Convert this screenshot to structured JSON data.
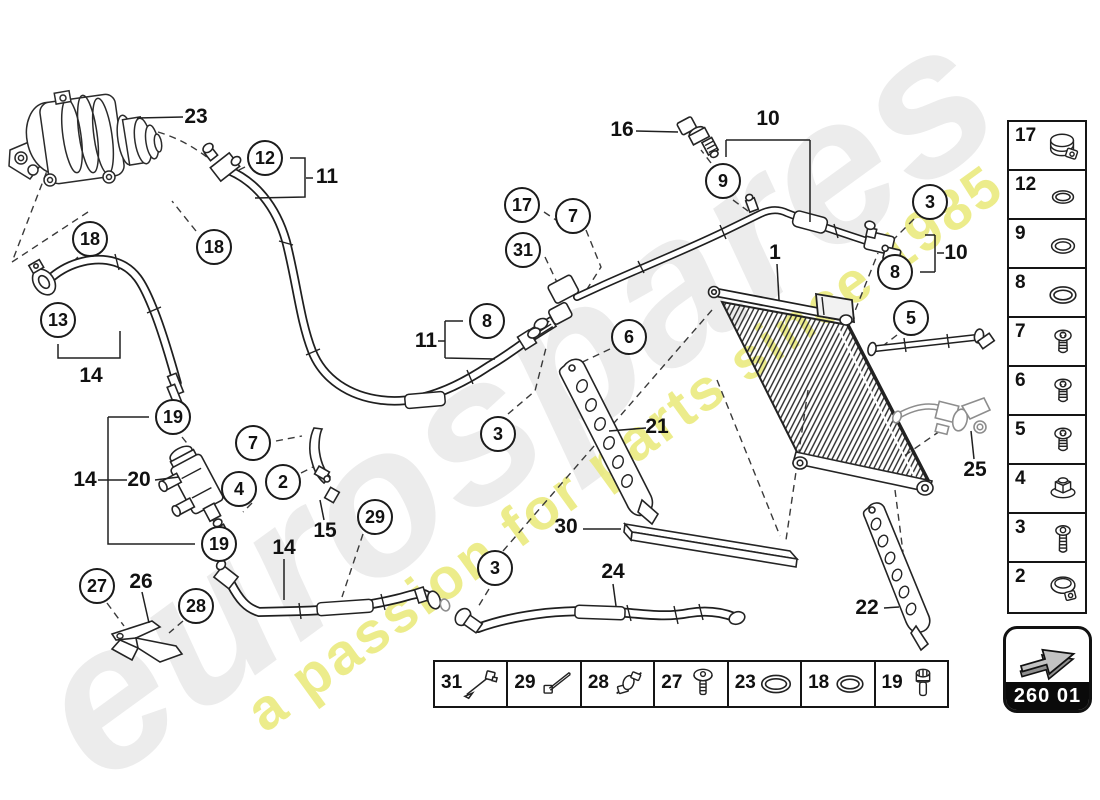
{
  "watermark": {
    "brand": "eurospares",
    "tagline": "a passion for parts since 1985"
  },
  "nav_box": {
    "code": "260 01"
  },
  "diagram": {
    "callouts": [
      {
        "n": "12",
        "x": 265,
        "y": 158
      },
      {
        "n": "18",
        "x": 90,
        "y": 239
      },
      {
        "n": "18",
        "x": 214,
        "y": 247
      },
      {
        "n": "13",
        "x": 58,
        "y": 320
      },
      {
        "n": "19",
        "x": 173,
        "y": 417
      },
      {
        "n": "7",
        "x": 253,
        "y": 443
      },
      {
        "n": "4",
        "x": 239,
        "y": 489
      },
      {
        "n": "2",
        "x": 283,
        "y": 482
      },
      {
        "n": "19",
        "x": 219,
        "y": 544
      },
      {
        "n": "27",
        "x": 97,
        "y": 586
      },
      {
        "n": "28",
        "x": 196,
        "y": 606
      },
      {
        "n": "29",
        "x": 375,
        "y": 517
      },
      {
        "n": "3",
        "x": 495,
        "y": 568
      },
      {
        "n": "3",
        "x": 498,
        "y": 434
      },
      {
        "n": "17",
        "x": 522,
        "y": 205
      },
      {
        "n": "7",
        "x": 573,
        "y": 216
      },
      {
        "n": "31",
        "x": 523,
        "y": 250
      },
      {
        "n": "8",
        "x": 487,
        "y": 321
      },
      {
        "n": "6",
        "x": 629,
        "y": 337
      },
      {
        "n": "9",
        "x": 723,
        "y": 181
      },
      {
        "n": "3",
        "x": 930,
        "y": 202
      },
      {
        "n": "8",
        "x": 895,
        "y": 272
      },
      {
        "n": "5",
        "x": 911,
        "y": 318
      }
    ],
    "labels": [
      {
        "n": "23",
        "x": 196,
        "y": 117
      },
      {
        "n": "11",
        "x": 327,
        "y": 177
      },
      {
        "n": "14",
        "x": 91,
        "y": 376
      },
      {
        "n": "14",
        "x": 85,
        "y": 480
      },
      {
        "n": "20",
        "x": 139,
        "y": 480
      },
      {
        "n": "26",
        "x": 141,
        "y": 582
      },
      {
        "n": "15",
        "x": 325,
        "y": 531
      },
      {
        "n": "14",
        "x": 284,
        "y": 548
      },
      {
        "n": "16",
        "x": 622,
        "y": 130
      },
      {
        "n": "10",
        "x": 768,
        "y": 119
      },
      {
        "n": "1",
        "x": 775,
        "y": 253
      },
      {
        "n": "10",
        "x": 956,
        "y": 253
      },
      {
        "n": "11",
        "x": 426,
        "y": 341
      },
      {
        "n": "21",
        "x": 657,
        "y": 427
      },
      {
        "n": "30",
        "x": 566,
        "y": 527
      },
      {
        "n": "24",
        "x": 613,
        "y": 572
      },
      {
        "n": "25",
        "x": 975,
        "y": 470
      },
      {
        "n": "22",
        "x": 867,
        "y": 608
      }
    ]
  },
  "sidebar_parts": [
    {
      "num": "17",
      "icon": "hose-clamp"
    },
    {
      "num": "12",
      "icon": "o-ring-s"
    },
    {
      "num": "9",
      "icon": "o-ring-m"
    },
    {
      "num": "8",
      "icon": "o-ring-l"
    },
    {
      "num": "7",
      "icon": "screw"
    },
    {
      "num": "6",
      "icon": "screw"
    },
    {
      "num": "5",
      "icon": "screw"
    },
    {
      "num": "4",
      "icon": "flange-nut"
    },
    {
      "num": "3",
      "icon": "screw-long"
    },
    {
      "num": "2",
      "icon": "band-clamp"
    }
  ],
  "tray_parts": [
    {
      "num": "31",
      "icon": "cable-tie-anchor"
    },
    {
      "num": "29",
      "icon": "cable-tie"
    },
    {
      "num": "28",
      "icon": "pipe-clip"
    },
    {
      "num": "27",
      "icon": "screw-dome"
    },
    {
      "num": "23",
      "icon": "o-ring-xl"
    },
    {
      "num": "18",
      "icon": "o-ring-l"
    },
    {
      "num": "19",
      "icon": "bolt"
    }
  ]
}
